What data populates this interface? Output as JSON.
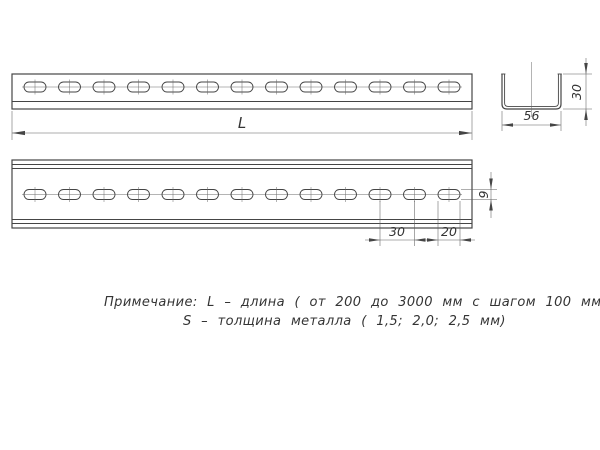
{
  "page": {
    "background": "#ffffff"
  },
  "drawing": {
    "line_color": "#454545",
    "views": {
      "front": {
        "hole_count": 13,
        "dim_length": "L"
      },
      "plan": {
        "hole_count": 13,
        "dim_hole_pitch": "30",
        "dim_hole_length": "20",
        "dim_hole_width": "9"
      },
      "section": {
        "dim_width": "56",
        "dim_height": "30"
      }
    },
    "note": {
      "line1": "Примечание: L – длина ( от 200 до 3000 мм с шагом 100 мм)",
      "line2": "S – толщина металла ( 1,5; 2,0; 2,5 мм)"
    }
  }
}
